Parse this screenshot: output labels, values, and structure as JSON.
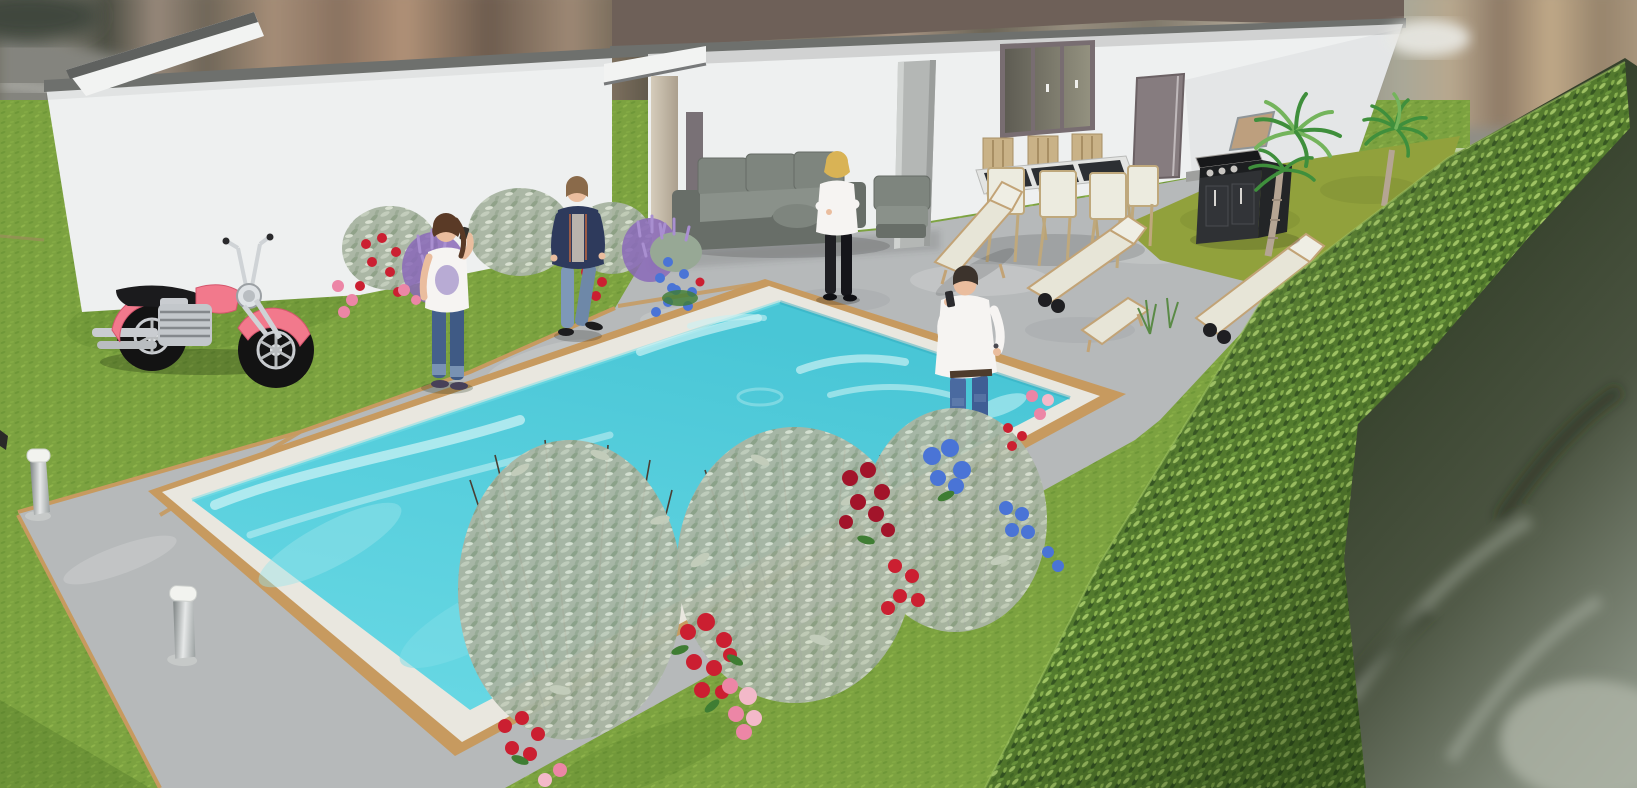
{
  "viewport": {
    "kind": "3d-exterior-render",
    "width": 1637,
    "height": 788,
    "description": "Sunlit 3D architectural rendering of a backyard: white flat-roof house with covered patio, turquoise swimming pool on a concrete deck, four people, a pink motorcycle on the lawn, flower beds, sun loungers, outdoor dining set, barbecue, two palm trees and a tall clipped hedge with a blurred neighbourhood beyond."
  },
  "palette": {
    "bg-base": "#8f8e86",
    "grass": "#7ca240",
    "grass-olive": "#91a13c",
    "grass-dark": "#5e8a2e",
    "deck": "#b6b9ba",
    "deck-light": "#d0d3d3",
    "deck-dark": "#9da0a1",
    "pool-trim": "#c79a5f",
    "coping": "#e9e7df",
    "water": "#58cfdd",
    "water-light": "#c9f1f4",
    "water-deep": "#2ea8bc",
    "wall": "#eef0f0",
    "wall-shade": "#d8dbdb",
    "fascia": "#6e706d",
    "roof": "#6e6058",
    "window-frame": "#786d71",
    "door": "#867c7f",
    "pillar": "#b4b7b5",
    "column": "#c6bcab",
    "canopy": "#f2f3f2",
    "sofa-base": "#686e68",
    "sofa-cushion": "#7e857e",
    "sofa-seat": "#8a918a",
    "wood": "#c2a376",
    "chair-cushion": "#ecebdf",
    "table-top": "#2c2f33",
    "lounger": "#e7e5d7",
    "bbq-body": "#2f3134",
    "bbq-side": "#232527",
    "bbq-lid": "#bd9f7e",
    "steel": "#c9ccd0",
    "hedge-base": "#557d2e",
    "hedge-light": "#a3c766",
    "hedge-mid": "#6f9c3f",
    "hedge-dark": "#365722",
    "palm-frond": "#3f8f3c",
    "palm-frond-light": "#74b45c",
    "palm-trunk": "#b5a593",
    "moto-pink": "#f2798c",
    "moto-pink-dark": "#d4566d",
    "tire": "#131313",
    "chrome": "#cfd3d6",
    "seat-black": "#1b1b1d",
    "skin": "#eabd9e",
    "hair-brown": "#5a3a26",
    "hair-lightbrown": "#8a6a4a",
    "hair-blonde": "#d9b355",
    "hair-dark": "#3c332c",
    "navy": "#2e3a5c",
    "denim-dark": "#45608c",
    "denim-mid": "#4a6aa0",
    "denim-light": "#7e98b8",
    "white-cloth": "#f6f4f2",
    "black-cloth": "#1e1e22",
    "flower-red": "#cb1f31",
    "flower-darkred": "#a2142a",
    "flower-pink": "#ec86a6",
    "flower-blue": "#4a74d6",
    "flower-purple": "#8a68b8",
    "flower-lilac": "#a98fd0",
    "sage": "#a9b5a3",
    "sage-light": "#c2ccba",
    "sage-dark": "#8da086",
    "leaf-green": "#3f7d33",
    "stem": "#4a3e33",
    "blur-dark": "#333f29",
    "blur-light": "#9aa295"
  },
  "scene": {
    "description": "Backyard 3D render with pool, house, people and garden",
    "environment": [
      {
        "name": "blurred-street-background",
        "cx": 818,
        "cy": 55
      },
      {
        "name": "blurred-trees-beyond-hedge",
        "cx": 1450,
        "cy": 560
      },
      {
        "name": "lawn",
        "cx": 400,
        "cy": 500
      },
      {
        "name": "olive-grass-strip",
        "cx": 1280,
        "cy": 215
      }
    ],
    "house": {
      "style": "modern flat roof, white render",
      "parts": [
        {
          "name": "garden-wall-left-wing",
          "cx": 330,
          "cy": 180
        },
        {
          "name": "sloped-parapet",
          "cx": 165,
          "cy": 50
        },
        {
          "name": "flat-roof",
          "cx": 1000,
          "cy": 25
        },
        {
          "name": "main-facade",
          "cx": 1020,
          "cy": 130
        },
        {
          "name": "sliding-window",
          "cx": 1048,
          "cy": 88
        },
        {
          "name": "entry-door",
          "cx": 1158,
          "cy": 127
        },
        {
          "name": "concrete-pillar",
          "cx": 915,
          "cy": 150
        },
        {
          "name": "patio-canopy-and-column",
          "cx": 660,
          "cy": 140
        }
      ]
    },
    "pool": {
      "name": "swimming-pool",
      "cx": 620,
      "cy": 490,
      "water": "turquoise",
      "border": "white coping with timber trim"
    },
    "people": [
      {
        "name": "girl-on-phone",
        "outfit": "white graphic tee, dark jeans",
        "cx": 446,
        "cy": 310
      },
      {
        "name": "woman-walking",
        "outfit": "navy puffer jacket, light jeans",
        "cx": 577,
        "cy": 265
      },
      {
        "name": "woman-arms-crossed",
        "outfit": "white blouse, black trousers",
        "cx": 837,
        "cy": 230
      },
      {
        "name": "man-on-phone",
        "outfit": "white shirt, blue jeans",
        "cx": 966,
        "cy": 380
      }
    ],
    "objects": [
      {
        "name": "pink-motorcycle",
        "cx": 200,
        "cy": 300
      },
      {
        "name": "outdoor-sofa-set",
        "cx": 790,
        "cy": 200
      },
      {
        "name": "round-ottoman",
        "cx": 797,
        "cy": 220
      },
      {
        "name": "dining-table-set",
        "cx": 1055,
        "cy": 200,
        "chairs": 7
      },
      {
        "name": "sun-loungers",
        "cx": 1100,
        "cy": 270,
        "count": 3
      },
      {
        "name": "lounger-stool",
        "cx": 1112,
        "cy": 320
      },
      {
        "name": "barbecue-grill",
        "cx": 1245,
        "cy": 185
      },
      {
        "name": "palm-tree-near",
        "cx": 1290,
        "cy": 180
      },
      {
        "name": "palm-tree-far",
        "cx": 1395,
        "cy": 165
      },
      {
        "name": "clipped-hedge",
        "cx": 1320,
        "cy": 450
      },
      {
        "name": "flower-bed-back",
        "cx": 500,
        "cy": 255,
        "flowers": [
          "lavender",
          "red roses",
          "pink roses",
          "blue morning glory",
          "silver foliage"
        ]
      },
      {
        "name": "flower-bed-front",
        "cx": 780,
        "cy": 580,
        "flowers": [
          "red roses",
          "pink roses",
          "blue hydrangea",
          "silver foliage"
        ]
      },
      {
        "name": "bollard-light-far",
        "cx": 38,
        "cy": 485
      },
      {
        "name": "bollard-light-near",
        "cx": 182,
        "cy": 625
      }
    ]
  }
}
